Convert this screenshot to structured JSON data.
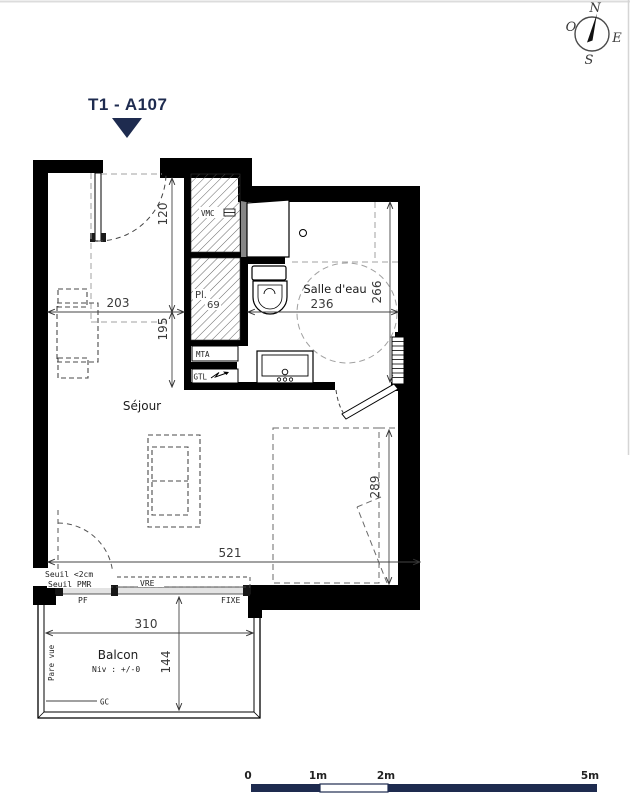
{
  "title": "T1 - A107",
  "colors": {
    "navy": "#1e2b4f",
    "wall": "#000000",
    "dim_text": "#3a3a3a"
  },
  "compass": {
    "n": "N",
    "o": "O",
    "e": "E",
    "s": "S"
  },
  "rooms": {
    "sejour": "Séjour",
    "salle_deau": "Salle d'eau",
    "balcon": "Balcon",
    "balcon_level": "Niv : +/-0",
    "placard": "Pl.",
    "placard_dim": "69"
  },
  "dims": {
    "entry_depth": "120",
    "entry_width": "203",
    "hall_depth": "195",
    "bath_width": "236",
    "bath_depth": "266",
    "bed_zone": "289",
    "sejour_width": "521",
    "balcon_width": "310",
    "balcon_depth": "144"
  },
  "tech": {
    "vmc": "VMC",
    "mta": "MTA",
    "gtl": "GTL",
    "pf": "PF",
    "vre": "VRE",
    "fixe": "FIXE",
    "seuil_2cm": "Seuil <2cm",
    "seuil_pmr": "Seuil PMR",
    "pare_vue": "Pare vue",
    "gc": "GC"
  },
  "scalebar": {
    "zero": "0",
    "one": "1m",
    "two": "2m",
    "five": "5m"
  }
}
